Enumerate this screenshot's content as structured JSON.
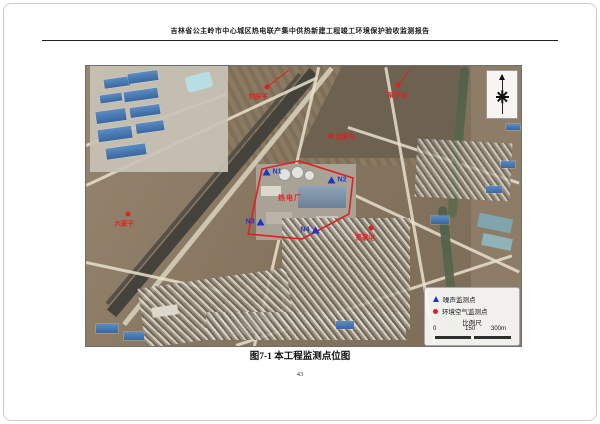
{
  "doc": {
    "header": "吉林省公主岭市中心城区热电联产集中供热新建工程竣工环境保护验收监测报告",
    "figure_caption": "图7-1 本工程监测点位图",
    "page_number": "43"
  },
  "map": {
    "plant_label": "热电厂",
    "boundary_points": "162,168 176,103 213,95 267,112 263,148 216,173",
    "noise_points": [
      {
        "id": "N1",
        "x": 186,
        "y": 106,
        "label_side": "right"
      },
      {
        "id": "N2",
        "x": 251,
        "y": 114,
        "label_side": "right"
      },
      {
        "id": "N3",
        "x": 169,
        "y": 156,
        "label_side": "left"
      },
      {
        "id": "N4",
        "x": 224,
        "y": 164,
        "label_side": "left"
      }
    ],
    "air_points": [
      {
        "name": "刘房子",
        "x": 181,
        "y": 21,
        "lx": -16,
        "ly": 6,
        "leader": [
          203,
          4
        ]
      },
      {
        "name": "苇子沟",
        "x": 312,
        "y": 19,
        "lx": -8,
        "ly": 7,
        "leader": [
          324,
          4
        ]
      },
      {
        "name": "六家子",
        "x": 42,
        "y": 148,
        "lx": -11,
        "ly": 6,
        "leader": null
      },
      {
        "name": "孟家屯",
        "x": 245,
        "y": 70,
        "lx": 7,
        "ly": -3,
        "leader": null
      },
      {
        "name": "范家屯",
        "x": 285,
        "y": 162,
        "lx": -13,
        "ly": 6,
        "leader": null
      }
    ],
    "legend": {
      "noise": "噪声监测点",
      "air": "环境空气监测点",
      "scale_title": "比例尺",
      "scale_ticks": [
        "0",
        "150",
        "300m"
      ]
    },
    "colors": {
      "noise_marker": "#1a35cc",
      "air_marker": "#e02020",
      "boundary": "#e02020"
    }
  }
}
